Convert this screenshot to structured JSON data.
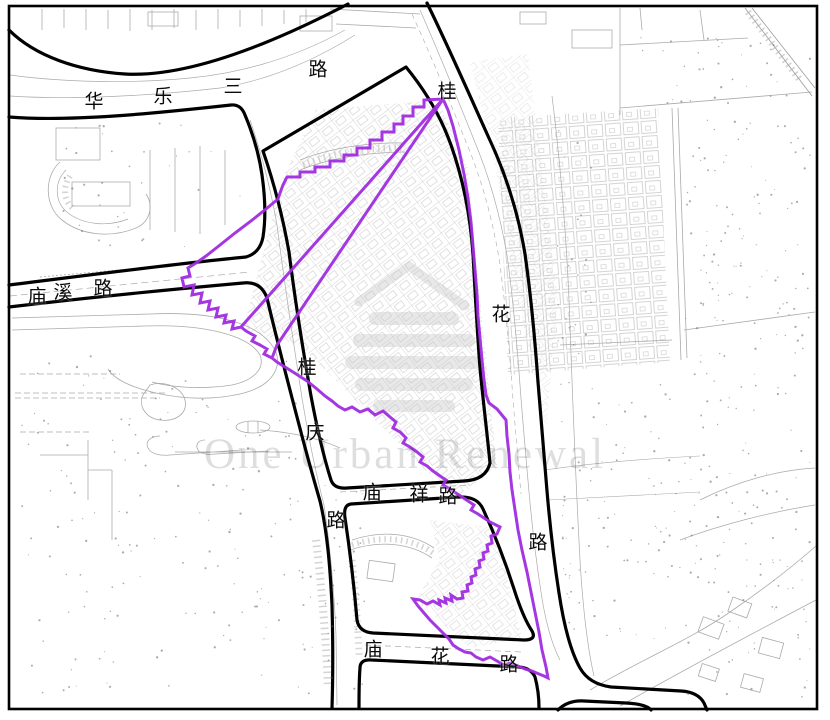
{
  "map": {
    "kind": "cadastral-urban-renewal-planning-map",
    "watermark": {
      "text": "One Urban Renewal",
      "logo": "striped-building-logo"
    },
    "colors": {
      "site_boundary": "#a02ce0",
      "road_edge": "#000000",
      "parcel_line": "#8f8f8f",
      "background": "#ffffff",
      "watermark_gray": "#cccccc"
    },
    "roads": [
      {
        "name": "华乐三路",
        "orientation": "horizontal-top",
        "chars": [
          [
            "华",
            94,
            100
          ],
          [
            "乐",
            163,
            95
          ],
          [
            "三",
            233,
            85
          ],
          [
            "路",
            318,
            68
          ]
        ]
      },
      {
        "name": "桂花路",
        "orientation": "vertical-right",
        "chars": [
          [
            "桂",
            447,
            90
          ],
          [
            "花",
            501,
            313
          ],
          [
            "路",
            538,
            541
          ]
        ]
      },
      {
        "name": "庙溪路",
        "orientation": "horizontal-left",
        "chars": [
          [
            "庙",
            37,
            295
          ],
          [
            "溪",
            63,
            291
          ],
          [
            "路",
            103,
            287
          ]
        ]
      },
      {
        "name": "桂庆路",
        "orientation": "vertical-center",
        "chars": [
          [
            "桂",
            307,
            366
          ],
          [
            "庆",
            315,
            431
          ],
          [
            "路",
            336,
            519
          ]
        ]
      },
      {
        "name": "庙祥路",
        "orientation": "horizontal-center",
        "chars": [
          [
            "庙",
            372,
            491
          ],
          [
            "祥",
            419,
            493
          ],
          [
            "路",
            448,
            495
          ]
        ]
      },
      {
        "name": "庙花路",
        "orientation": "horizontal-bottom",
        "chars": [
          [
            "庙",
            373,
            648
          ],
          [
            "花",
            440,
            655
          ],
          [
            "路",
            509,
            663
          ]
        ]
      }
    ]
  }
}
